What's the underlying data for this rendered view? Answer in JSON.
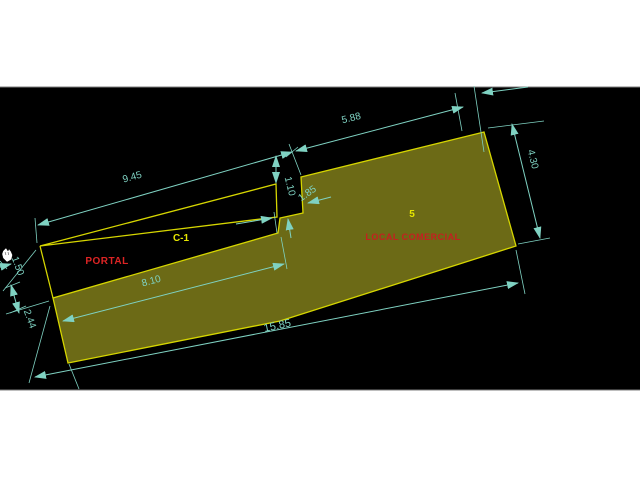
{
  "drawing": {
    "labels": {
      "room_c1": "C-1",
      "portal": "PORTAL",
      "unit_number": "5",
      "local_comercial": "LOCAL COMERCIAL"
    },
    "dimensions": {
      "top_left": "9.45",
      "top_right": "5.88",
      "step_drop": "1.10",
      "step_width": "1.85",
      "right_end_width": "4.30",
      "portal_strip_length": "8.10",
      "total_length": "15.85",
      "left_upper": "1.50",
      "left_end_width": "2.44"
    },
    "colors": {
      "page_background": "#ffffff",
      "canvas_background": "#000000",
      "dimension_lines": "#7fd2c2",
      "outline_yellow": "#d6d600",
      "fill_olive": "#6c6a16",
      "label_yellow": "#e6e600",
      "label_red": "#dd2424"
    }
  }
}
